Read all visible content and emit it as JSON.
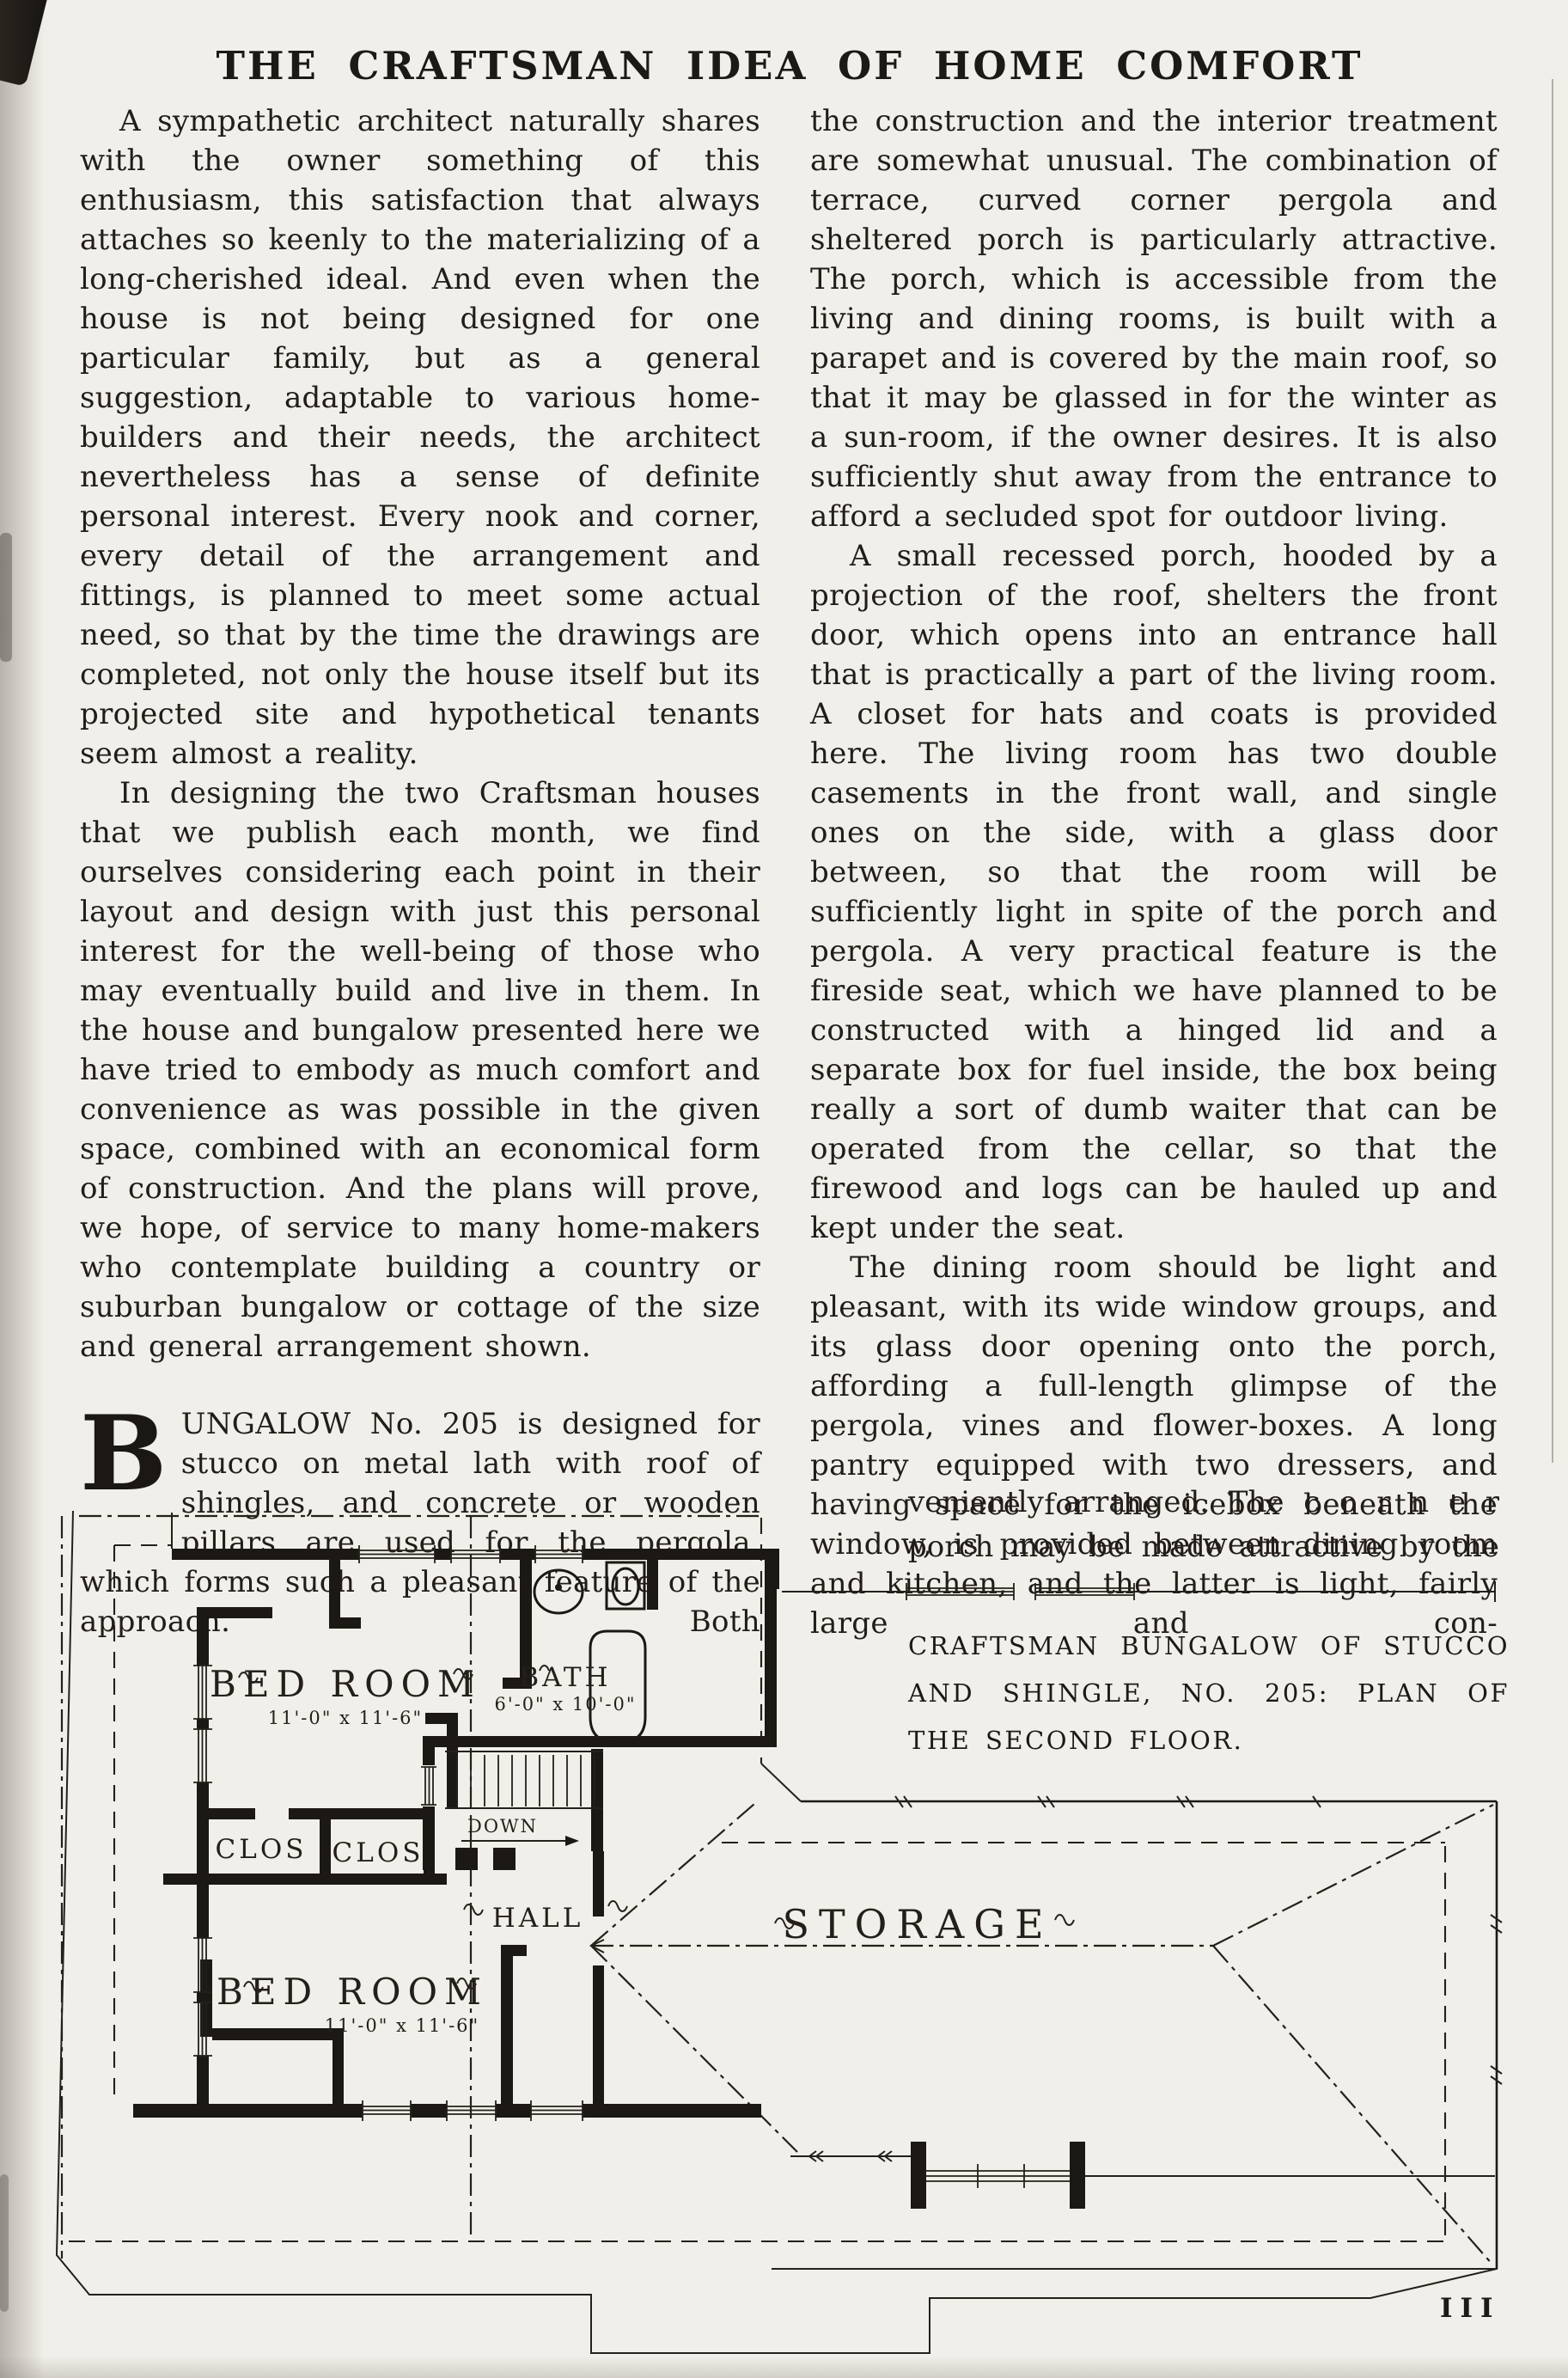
{
  "page": {
    "title": "THE CRAFTSMAN IDEA OF HOME COMFORT",
    "page_number": "III"
  },
  "article": {
    "left_column": {
      "p1": "A sympathetic architect naturally shares with the owner something of this enthusiasm, this satisfaction that always attaches so keenly to the materializing of a long-cherished ideal. And even when the house is not being designed for one particular family, but as a general suggestion, adaptable to various home-builders and their needs, the architect nevertheless has a sense of definite personal interest. Every nook and corner, every detail of the arrangement and fittings, is planned to meet some actual need, so that by the time the drawings are completed, not only the house itself but its projected site and hypothetical tenants seem almost a reality.",
      "p2": "In designing the two Craftsman houses that we publish each month, we find ourselves considering each point in their layout and design with just this personal interest for the well-being of those who may eventually build and live in them. In the house and bungalow presented here we have tried to embody as much comfort and convenience as was possible in the given space, combined with an economical form of construction. And the plans will prove, we hope, of service to many home-makers who contemplate building a country or suburban bungalow or cottage of the size and general arrangement shown.",
      "dropcap_initial": "B",
      "dropcap_text": "UNGALOW No. 205 is designed for stucco on metal lath with roof of shingles, and concrete or wooden pillars are used for the pergola, which forms such a pleasant feature of the approach. Both"
    },
    "right_column": {
      "p1": "the construction and the interior treatment are somewhat unusual. The combination of terrace, curved corner pergola and sheltered porch is particularly attractive. The porch, which is accessible from the living and dining rooms, is built with a parapet and is covered by the main roof, so that it may be glassed in for the winter as a sun-room, if the owner desires. It is also sufficiently shut away from the entrance to afford a secluded spot for outdoor living.",
      "p2": "A small recessed porch, hooded by a projection of the roof, shelters the front door, which opens into an entrance hall that is practically a part of the living room. A closet for hats and coats is provided here. The living room has two double casements in the front wall, and single ones on the side, with a glass door between, so that the room will be sufficiently light in spite of the porch and pergola. A very practical feature is the fireside seat, which we have planned to be constructed with a hinged lid and a separate box for fuel inside, the box being really a sort of dumb waiter that can be operated from the cellar, so that the firewood and logs can be hauled up and kept under the seat.",
      "p3": "The dining room should be light and pleasant, with its wide window groups, and its glass door opening onto the porch, affording a full-length glimpse of the pergola, vines and flower-boxes. A long pantry equipped with two dressers, and having space for the icebox beneath the window, is provided between dining room and kitchen, and the latter is light, fairly large and con-",
      "continuation_line1": "veniently arranged.  The  c o r n e r",
      "continuation_line2": "porch may be made attractive by the"
    }
  },
  "figure": {
    "caption": "CRAFTSMAN BUNGALOW OF STUCCO AND SHINGLE, NO. 205: PLAN OF THE SECOND FLOOR.",
    "plan": {
      "bedroom1": {
        "label": "BED ROOM",
        "dims": "11'-0\" x 11'-6\""
      },
      "bedroom2": {
        "label": "BED ROOM",
        "dims": "11'-0\" x 11'-6\""
      },
      "bath": {
        "label": "BATH",
        "dims": "6'-0\" x 10'-0\""
      },
      "closet1": {
        "label": "CLOS"
      },
      "closet2": {
        "label": "CLOS"
      },
      "hall": {
        "label": "HALL"
      },
      "storage": {
        "label": "STORAGE"
      },
      "stairs": {
        "label": "DOWN"
      }
    }
  }
}
